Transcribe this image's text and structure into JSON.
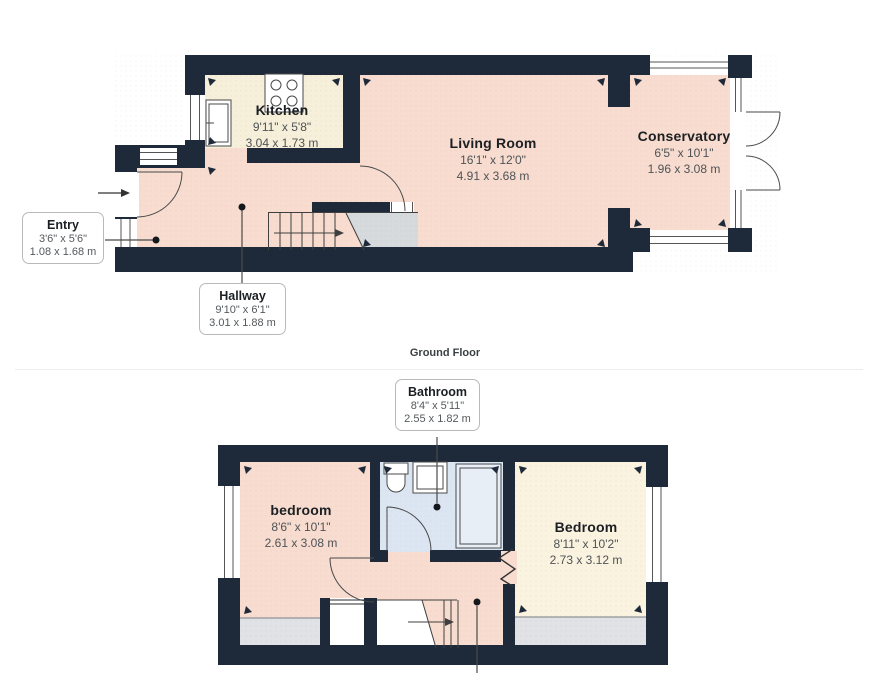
{
  "colors": {
    "wall": "#1e2a3a",
    "floor_peach": "#f7dccf",
    "floor_cream": "#f6efd9",
    "floor_cream_light": "#faf3df",
    "floor_bath": "#dce6f2",
    "floor_gray": "#e0e2e5",
    "stair_gray": "#d6dadd"
  },
  "ground_floor": {
    "caption": "Ground Floor",
    "kitchen": {
      "name": "Kitchen",
      "imperial": "9'11\" x 5'8\"",
      "metric": "3.04 x 1.73 m"
    },
    "living_room": {
      "name": "Living Room",
      "imperial": "16'1\" x 12'0\"",
      "metric": "4.91 x 3.68 m"
    },
    "conservatory": {
      "name": "Conservatory",
      "imperial": "6'5\" x 10'1\"",
      "metric": "1.96 x 3.08 m"
    },
    "entry": {
      "name": "Entry",
      "imperial": "3'6\" x 5'6\"",
      "metric": "1.08 x 1.68 m"
    },
    "hallway": {
      "name": "Hallway",
      "imperial": "9'10\" x 6'1\"",
      "metric": "3.01 x 1.88 m"
    }
  },
  "first_floor": {
    "bedroom_left": {
      "name": "bedroom",
      "imperial": "8'6\" x 10'1\"",
      "metric": "2.61 x 3.08 m"
    },
    "bedroom_right": {
      "name": "Bedroom",
      "imperial": "8'11\" x 10'2\"",
      "metric": "2.73 x 3.12 m"
    },
    "bathroom": {
      "name": "Bathroom",
      "imperial": "8'4\" x 5'11\"",
      "metric": "2.55 x 1.82 m"
    }
  }
}
